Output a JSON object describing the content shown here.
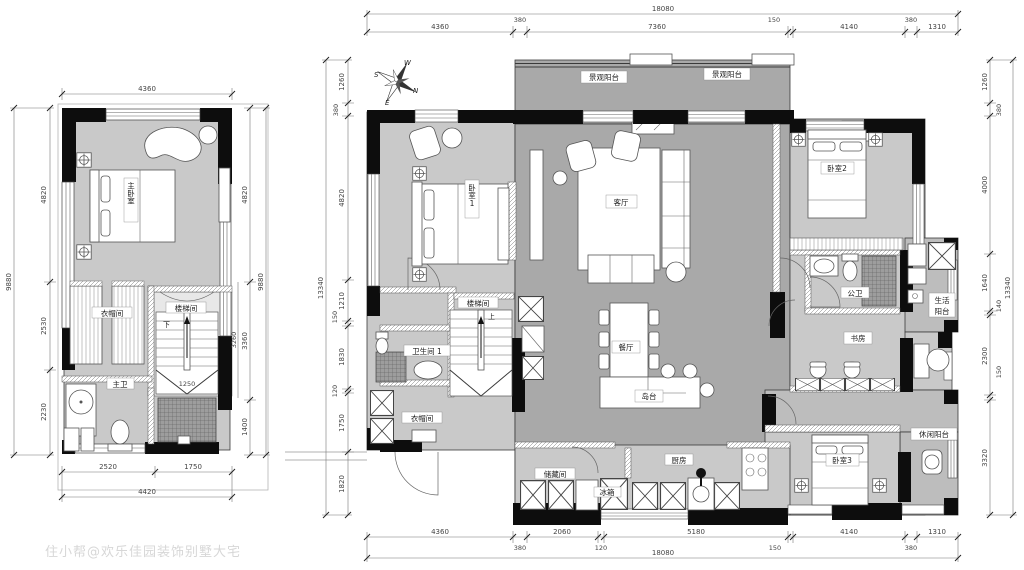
{
  "watermark": "住小帮@欢乐佳园装饰别墅大宅",
  "compass": {
    "n": "N",
    "s": "S",
    "e": "E",
    "w": "W"
  },
  "palette": {
    "room_light": "#c9c9c9",
    "open_gray": "#a9a9a9",
    "balcony_gray": "#bdbdbd",
    "wall_black": "#0d0d0d"
  },
  "left_plan": {
    "rooms": {
      "master_bedroom": "主卧室",
      "closet": "衣帽间",
      "stair": "楼梯间",
      "stair_down": "下",
      "master_bath": "主卫"
    },
    "dims": {
      "top": [
        "4360"
      ],
      "left_total": "9880",
      "left": [
        "4820",
        "2530",
        "2230"
      ],
      "right_total": "9880",
      "right": [
        "4820",
        "3360",
        "1400"
      ],
      "right_inner": [
        "3260"
      ],
      "stair_width": "1250",
      "bottom": [
        "2520",
        "1750"
      ],
      "bottom_total": "4420"
    }
  },
  "main_plan": {
    "rooms": {
      "view_balcony_1": "景观阳台",
      "view_balcony_2": "景观阳台",
      "bedroom1": "卧室1",
      "living": "客厅",
      "stair": "楼梯间",
      "stair_up": "上",
      "bath1": "卫生间 1",
      "closet": "衣帽间",
      "dining": "餐厅",
      "island": "岛台",
      "storage": "储藏间",
      "fridge": "冰箱",
      "kitchen": "厨房",
      "bedroom2": "卧室2",
      "public_bath": "公卫",
      "service_balcony": {
        "line1": "生活",
        "line2": "阳台"
      },
      "study": "书房",
      "leisure_balcony": "休闲阳台",
      "bedroom3": "卧室3"
    },
    "dims": {
      "top_total": "18080",
      "top": [
        "4360",
        "380",
        "7360",
        "150",
        "4140",
        "380",
        "1310"
      ],
      "bottom": [
        "4360",
        "380",
        "2060",
        "120",
        "5180",
        "150",
        "4140",
        "380",
        "1310"
      ],
      "bottom_total": "18080",
      "left_total": "13340",
      "left": [
        "1260",
        "380",
        "4820",
        "1210",
        "150",
        "1830",
        "120",
        "1750",
        "1820"
      ],
      "right": [
        "1260",
        "380",
        "4000",
        "1640",
        "140",
        "2300",
        "150",
        "3320"
      ],
      "right_total": "13340"
    }
  }
}
